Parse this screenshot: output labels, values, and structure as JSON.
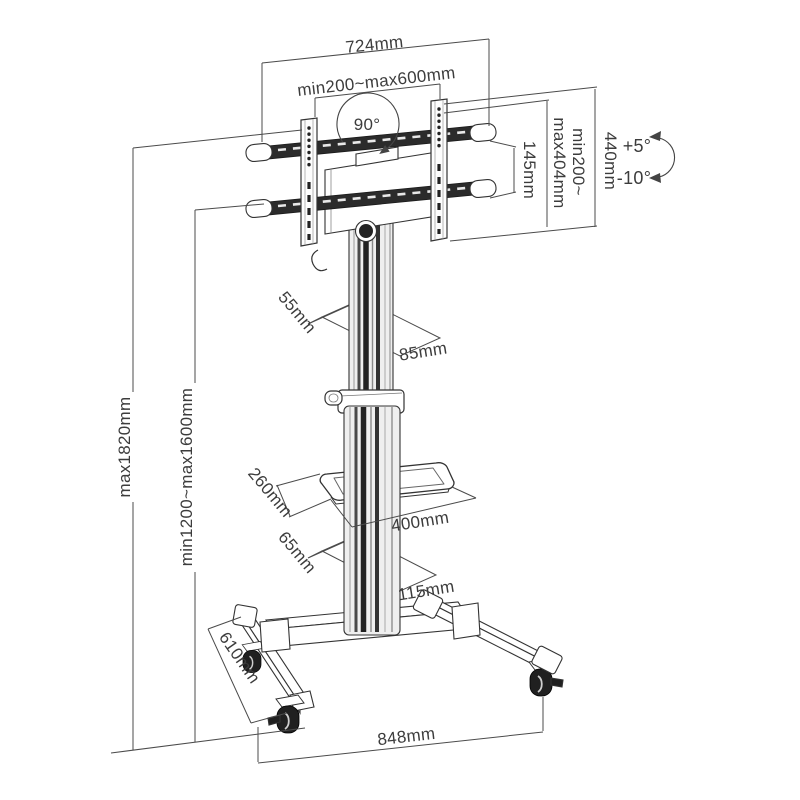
{
  "diagram": {
    "type": "technical-dimension-drawing",
    "subject": "mobile-tv-floor-stand",
    "colors": {
      "background": "#ffffff",
      "structure_line": "#333333",
      "dark_fill": "#2b2b2b",
      "dimension_line": "#4b4b4b",
      "label_text": "#3c3c3c"
    },
    "dimensions": {
      "top_width": "724mm",
      "vesa_width_range": "min200~max600mm",
      "rotation": "90°",
      "rail_spacing": "145mm",
      "vesa_height_line1": "min200~",
      "vesa_height_line2": "max404mm",
      "bracket_height": "440mm",
      "tilt_up": "+5°",
      "tilt_down": "-10°",
      "height_max": "max1820mm",
      "height_range": "min1200~max1600mm",
      "column_depth": "55mm",
      "column_width": "85mm",
      "shelf_depth": "260mm",
      "shelf_width": "400mm",
      "base_column_depth": "65mm",
      "base_column_width": "115mm",
      "leg_length": "610mm",
      "base_width": "848mm"
    }
  }
}
